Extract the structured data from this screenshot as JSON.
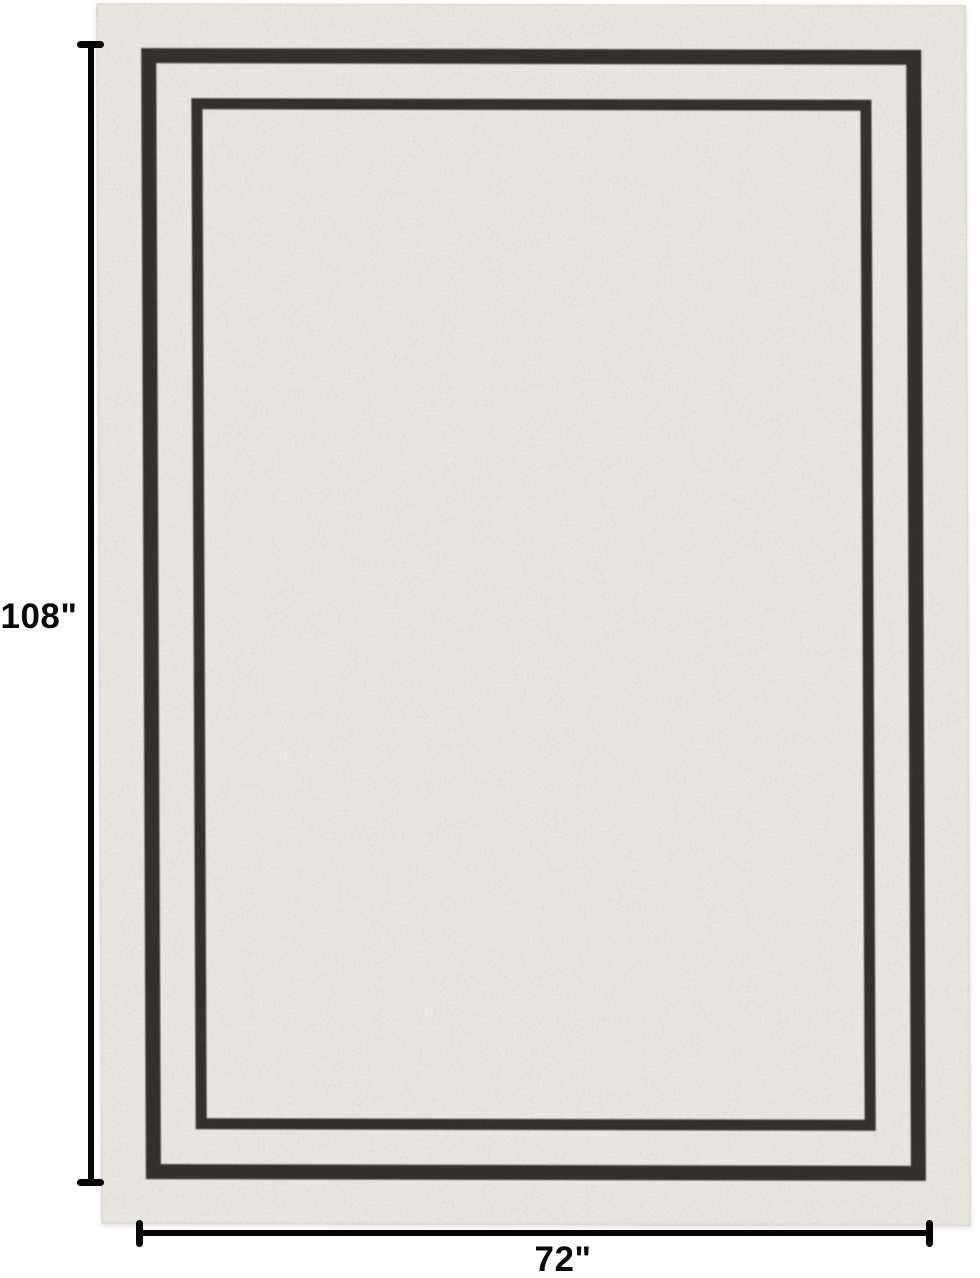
{
  "image": {
    "type": "product-dimension-photo",
    "subject": "rectangular ivory area rug with double black line border",
    "background": "#ffffff"
  },
  "dimensions": {
    "height_label": "108\"",
    "width_label": "72\""
  },
  "colors": {
    "rug_base": "#f2f0e9",
    "rug_border": "#2d2b28",
    "annotation_line": "#000000",
    "label_text": "#0a0a0a"
  }
}
